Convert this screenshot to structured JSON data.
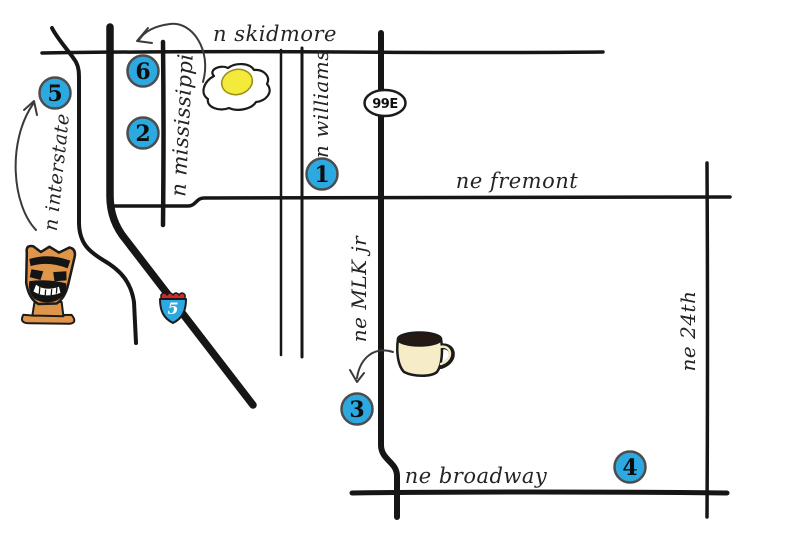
{
  "map": {
    "streets": {
      "skidmore": "n skidmore",
      "mississippi": "n mississippi",
      "williams": "n williams",
      "fremont": "ne fremont",
      "mlk": "ne MLK jr",
      "broadway": "ne broadway",
      "ne24th": "ne 24th",
      "interstate": "n interstate"
    },
    "shields": {
      "route99e": "99E",
      "i5": "5"
    },
    "markers": [
      {
        "label": "1"
      },
      {
        "label": "2"
      },
      {
        "label": "3"
      },
      {
        "label": "4"
      },
      {
        "label": "5"
      },
      {
        "label": "6"
      }
    ],
    "illustrations": [
      {
        "name": "fried-egg-icon"
      },
      {
        "name": "coffee-mug-icon"
      },
      {
        "name": "tiki-statue-icon"
      }
    ],
    "colors": {
      "marker_blue": "#2BA9E0",
      "shield_blue": "#2BA9E0",
      "shield_red": "#D3282A",
      "ink": "#161616",
      "egg_yolk": "#F3EA3C",
      "mug_cream": "#F6ECC7",
      "coffee": "#241A13",
      "tiki_orange": "#E0964A"
    }
  }
}
